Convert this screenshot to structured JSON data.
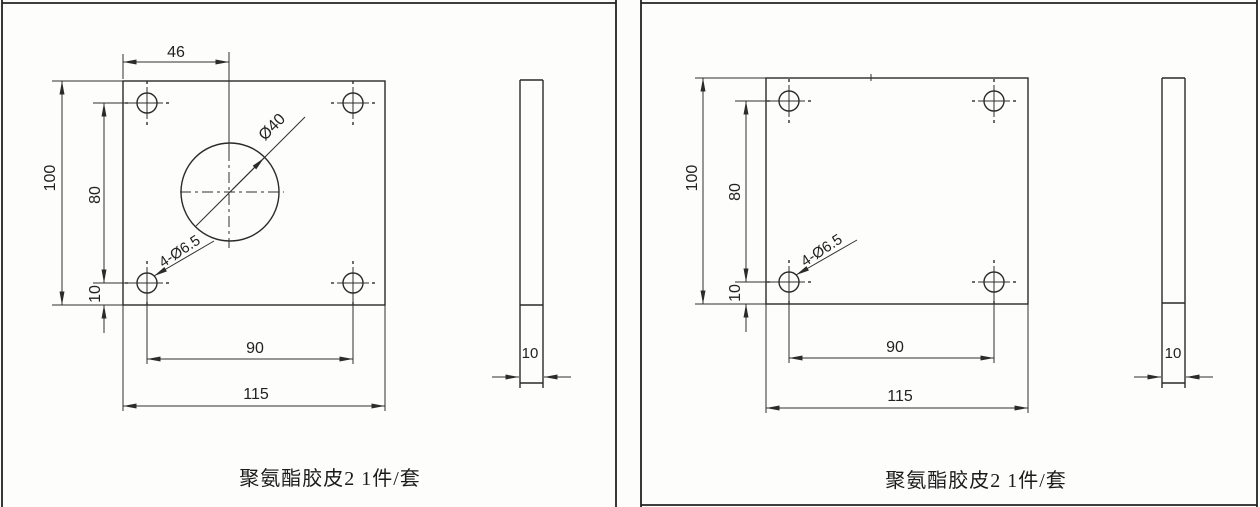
{
  "drawing": {
    "left_sheet": {
      "caption": "聚氨酯胶皮2 1件/套",
      "front_view": {
        "hole_offset_top_label": "46",
        "plate_height_label": "100",
        "hole_row_spacing_label": "80",
        "hole_bottom_offset_label": "10",
        "hole_col_spacing_label": "90",
        "plate_width_label": "115",
        "corner_holes_label": "4-Ø6.5",
        "center_hole_label": "Ø40"
      },
      "side_view": {
        "thickness_label": "10"
      }
    },
    "right_sheet": {
      "caption": "聚氨酯胶皮2 1件/套",
      "front_view": {
        "plate_height_label": "100",
        "hole_row_spacing_label": "80",
        "hole_bottom_offset_label": "10",
        "hole_col_spacing_label": "90",
        "plate_width_label": "115",
        "corner_holes_label": "4-Ø6.5"
      },
      "side_view": {
        "thickness_label": "10"
      }
    }
  }
}
